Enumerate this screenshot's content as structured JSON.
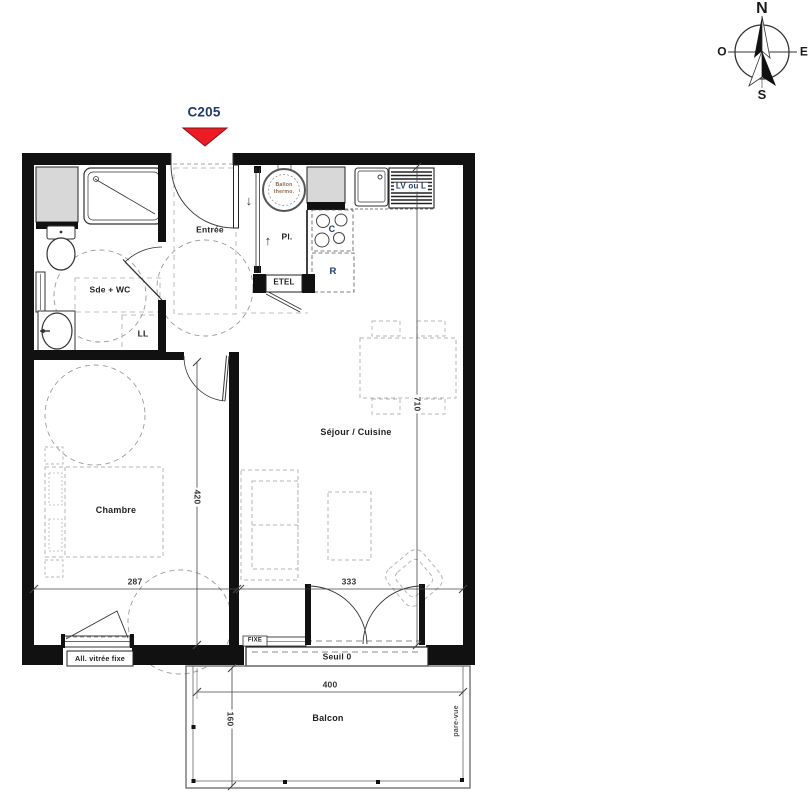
{
  "unit": {
    "label": "C205"
  },
  "compass": {
    "north": "N",
    "south": "S",
    "east": "E",
    "west": "O"
  },
  "rooms": {
    "entree": "Entrée",
    "sde_wc": "Sde + WC",
    "chambre": "Chambre",
    "sejour_cuisine": "Séjour / Cuisine",
    "balcon": "Balcon",
    "placard": "Pl.",
    "etel": "ETEL"
  },
  "equipment": {
    "ballon_line1": "Ballon",
    "ballon_line2": "thermo.",
    "lave_linge": "LL",
    "lave_vaisselle_ou_lave_linge": "LV ou L",
    "refrigerateur": "R",
    "cuisson": "C"
  },
  "annotations": {
    "allege_vitree": "All. vitrée fixe",
    "seuil": "Seuil 0",
    "chassis_fixe": "FIXE",
    "pare_vue": "pare-vue",
    "arrow_down": "↓",
    "arrow_up": "↑"
  },
  "dimensions": {
    "chambre_largeur": "287",
    "chambre_profondeur": "420",
    "sejour_largeur": "333",
    "logement_profondeur": "710",
    "balcon_largeur": "400",
    "balcon_profondeur": "160"
  },
  "colors": {
    "wall": "#111111",
    "entrance_arrow_red": "#ec1c24",
    "label_navy": "#1e3a6e",
    "shaft_gray": "#d8d8d8"
  }
}
